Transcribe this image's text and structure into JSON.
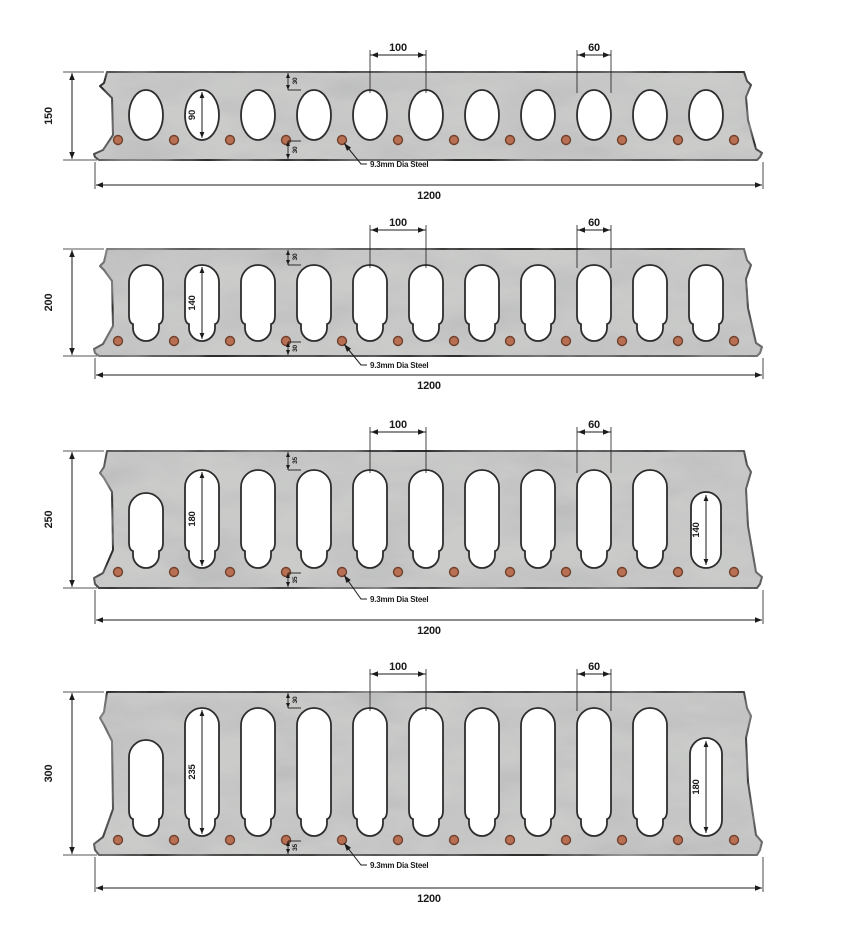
{
  "title": "Hollow-core slab cross sections",
  "drawing": {
    "colors": {
      "background": "#ffffff",
      "concrete": "#cbccca",
      "outline": "#2d2d2d",
      "void_fill": "#ffffff",
      "dim": "#1b1b1b",
      "steel_fill": "#b96f52",
      "steel_stroke": "#70412f"
    },
    "shared": {
      "width_label": "1200",
      "pitch_label": "100",
      "void_width_label": "60",
      "steel_label": "9.3mm Dia Steel",
      "void_count": 11,
      "steel_count": 12
    },
    "sections": [
      {
        "id": "section-150",
        "depth_label": "150",
        "void_height_label": "90",
        "top_cover_label": "30",
        "bottom_cover_label": "30",
        "void_style": "oval",
        "void_count": 11,
        "steel_count": 12
      },
      {
        "id": "section-200",
        "depth_label": "200",
        "void_height_label": "140",
        "top_cover_label": "30",
        "bottom_cover_label": "30",
        "void_style": "keyhole",
        "void_count": 11,
        "steel_count": 12
      },
      {
        "id": "section-250",
        "depth_label": "250",
        "void_height_label": "180",
        "top_cover_label": "35",
        "bottom_cover_label": "35",
        "void_style": "keyhole",
        "first_void": "short",
        "end_void_height_label": "140",
        "void_count": 11,
        "steel_count": 12
      },
      {
        "id": "section-300",
        "depth_label": "300",
        "void_height_label": "235",
        "top_cover_label": "30",
        "bottom_cover_label": "35",
        "void_style": "keyhole",
        "first_void": "short",
        "end_void_height_label": "180",
        "void_count": 11,
        "steel_count": 12
      }
    ]
  }
}
